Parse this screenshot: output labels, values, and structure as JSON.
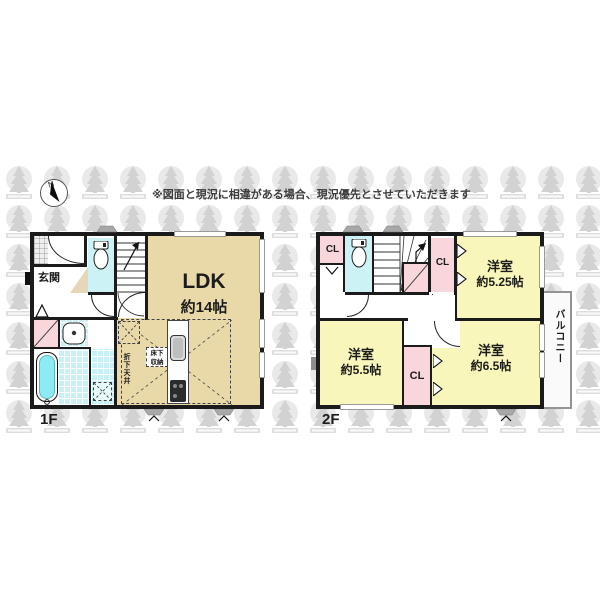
{
  "disclaimer": "※図面と現況に相違がある場合、現況優先とさせていただきます",
  "compass": {
    "north_label": "N"
  },
  "colors": {
    "wall": "#1b1b1b",
    "ldk_fill": "#ead9a8",
    "bedroom_fill": "#f8f6ba",
    "closet_fill": "#f9d6dc",
    "wet_area_fill": "#cdf2f6",
    "bathtub_fill": "#8febf3",
    "watermark_gray": "#e9e9e9"
  },
  "floor1": {
    "label": "1F",
    "entrance_label": "玄関",
    "ldk_label": "LDK",
    "ldk_size": "約14帖",
    "underfloor_storage_line1": "床下",
    "underfloor_storage_line2": "収納",
    "dropped_ceiling": "折下天井"
  },
  "floor2": {
    "label": "2F",
    "closet_label": "CL",
    "balcony_label": "バルコニー",
    "room_ne": {
      "name": "洋室",
      "size": "約5.25帖"
    },
    "room_sw": {
      "name": "洋室",
      "size": "約5.5帖"
    },
    "room_se": {
      "name": "洋室",
      "size": "約6.5帖"
    }
  }
}
